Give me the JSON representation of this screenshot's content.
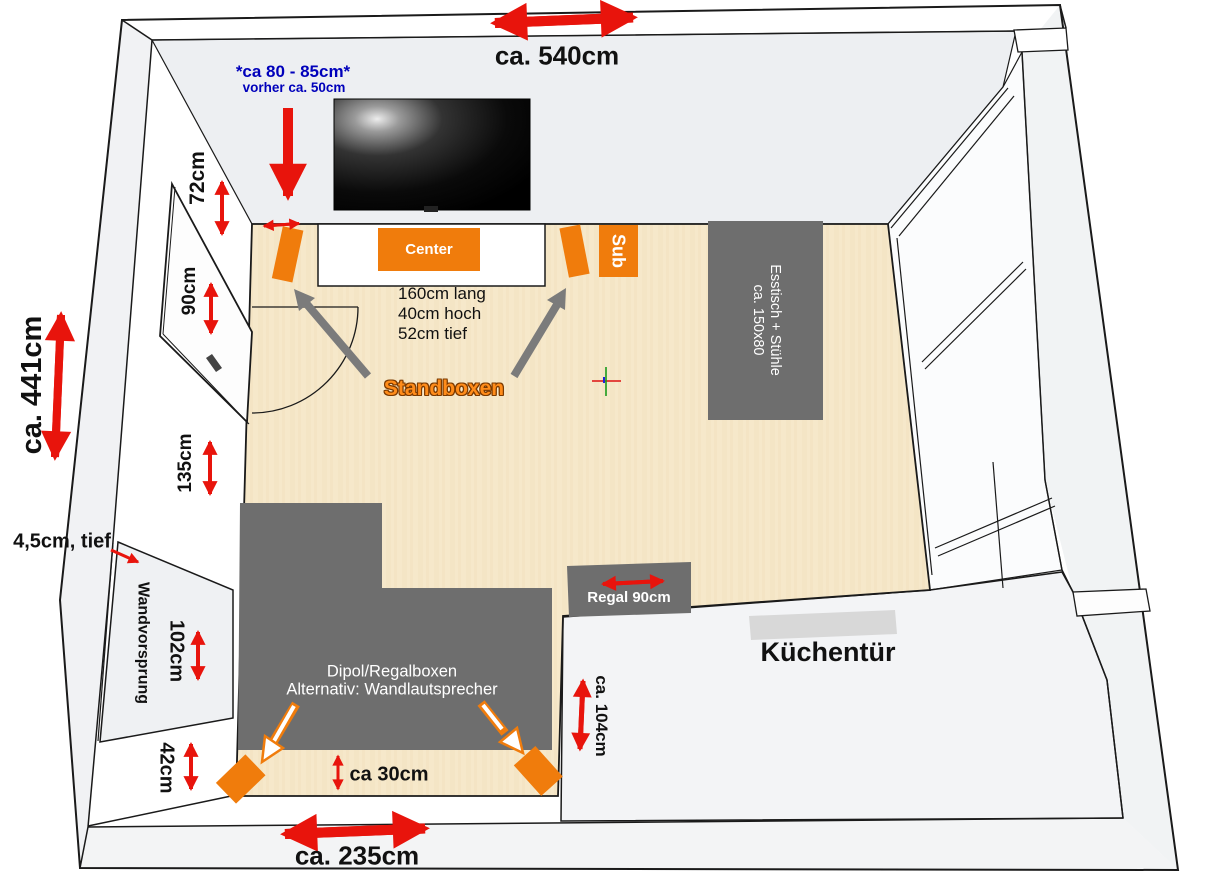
{
  "labels": {
    "top_width": "ca. 540cm",
    "tv_offset": "*ca 80 - 85cm*",
    "tv_offset_prev": "vorher ca. 50cm",
    "dim_72": "72cm",
    "dim_90": "90cm",
    "dim_135": "135cm",
    "room_depth": "ca. 441cm",
    "niche_depth": "4,5cm, tief",
    "wall_protrusion": "Wandvorsprung",
    "dim_102": "102cm",
    "dim_42": "42cm",
    "center_speaker": "Center",
    "subwoofer": "Sub",
    "lowboard_specs": [
      "160cm lang",
      "40cm hoch",
      "52cm tief"
    ],
    "standboxen": "Standboxen",
    "dining_line1": "Esstisch + Stühle",
    "dining_line2": "ca. 150x80",
    "shelf": "Regal 90cm",
    "kitchen_door": "Küchentür",
    "rear_line1": "Dipol/Regalboxen",
    "rear_line2": "Alternativ: Wandlautsprecher",
    "dim_30": "ca 30cm",
    "dim_104": "ca. 104cm",
    "bottom_width": "ca. 235cm"
  },
  "colors": {
    "accent_orange": "#f07c0c",
    "arrow_red": "#e8140c",
    "note_blue": "#0000bb",
    "furniture_gray": "#6e6e6e",
    "floor_beige": "#f6e8ca",
    "kitchen_door_gray": "#d8d8d8"
  }
}
